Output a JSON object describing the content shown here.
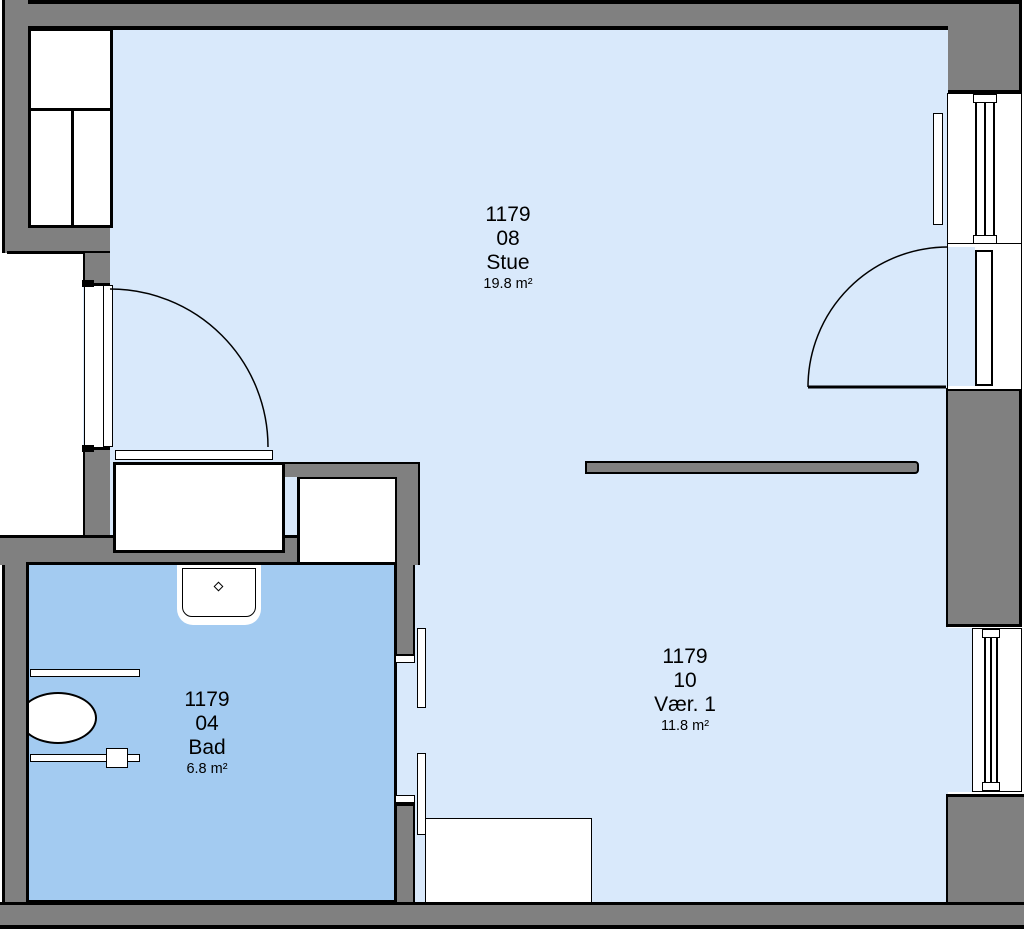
{
  "colors": {
    "wall": "#808080",
    "outline": "#000000",
    "floor_light": "#D9E9FB",
    "floor_bath": "#A3CBF1",
    "fixture_fill": "#FFFFFF"
  },
  "rooms": {
    "stue": {
      "number": "1179",
      "code": "08",
      "name": "Stue",
      "area": "19.8 m²"
    },
    "bad": {
      "number": "1179",
      "code": "04",
      "name": "Bad",
      "area": "6.8 m²"
    },
    "vaer1": {
      "number": "1179",
      "code": "10",
      "name": "Vær. 1",
      "area": "11.8 m²"
    }
  },
  "fixtures": [
    "entrance-door",
    "wardrobe",
    "sliding-door-track",
    "bath-vestibule",
    "sink",
    "toilet",
    "grab-bar",
    "toilet-roll-holder",
    "bath-sliding-door",
    "radiator",
    "window",
    "balcony-door",
    "bedroom-furniture",
    "room-divider"
  ]
}
